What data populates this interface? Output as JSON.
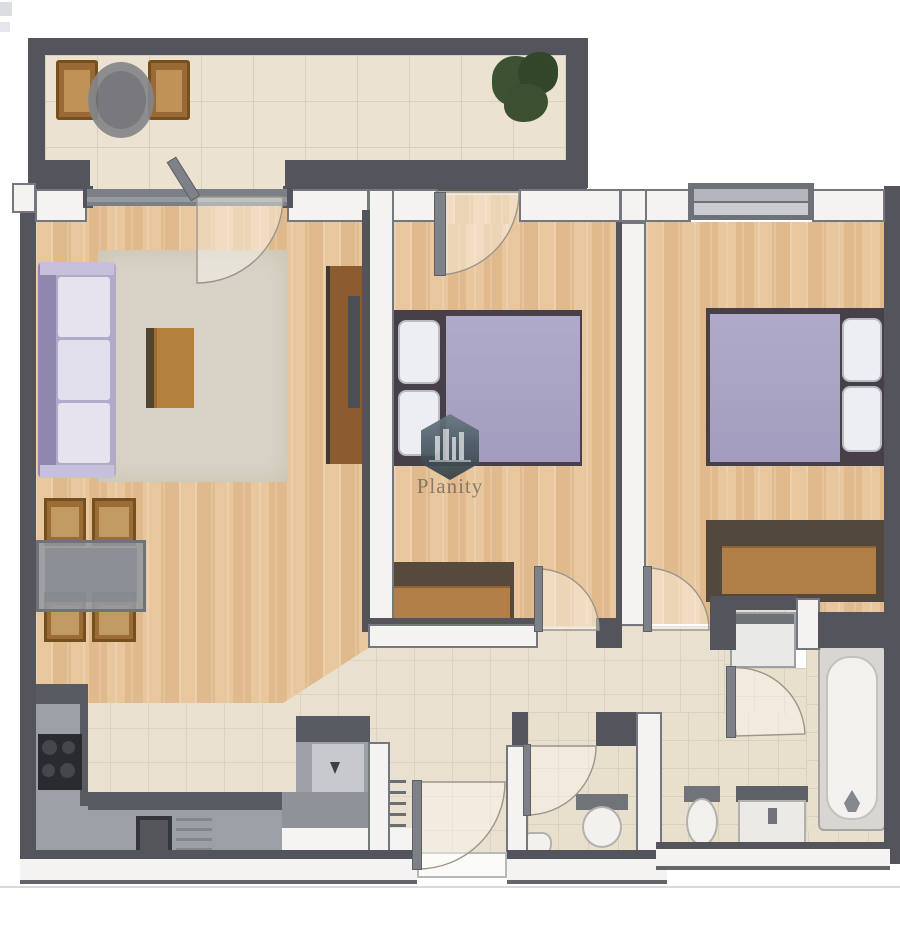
{
  "watermark": {
    "brand": "Planity",
    "logo": "hexagon-with-building-skyline"
  },
  "plan": {
    "type": "apartment-floor-plan-3d-top-view",
    "rooms": [
      {
        "name": "balcony",
        "furniture": [
          "wood-chair",
          "wood-chair",
          "round-table",
          "potted-plant"
        ]
      },
      {
        "name": "living-room",
        "furniture": [
          "lavender-sofa",
          "area-rug",
          "coffee-table",
          "tv-cabinet",
          "dining-table",
          "dining-chair-x4"
        ]
      },
      {
        "name": "kitchen",
        "furniture": [
          "cooktop",
          "sink-with-drainboard",
          "counter-left",
          "counter-bottom",
          "counter-peninsula"
        ]
      },
      {
        "name": "bedroom-1",
        "furniture": [
          "double-bed-lavender",
          "pillow-x2",
          "dresser"
        ]
      },
      {
        "name": "bedroom-2",
        "furniture": [
          "double-bed-lavender",
          "pillow-x2",
          "dresser",
          "window"
        ]
      },
      {
        "name": "entry-hall",
        "furniture": [
          "radiator",
          "entry-door"
        ]
      },
      {
        "name": "wc",
        "furniture": [
          "toilet",
          "corner-sink"
        ]
      },
      {
        "name": "bathroom",
        "furniture": [
          "bathtub",
          "toilet",
          "vanity-sink",
          "washing-machine"
        ]
      }
    ],
    "doors": [
      "living-balcony-door",
      "bedroom1-balcony-door",
      "bedroom1-door",
      "bedroom2-door",
      "wc-door",
      "bathroom-door",
      "entry-door"
    ]
  },
  "colors": {
    "wall_dark": "#53545c",
    "wall_white": "#f4f3f1",
    "wood_floor": "#e5c094",
    "tile_floor": "#eae0cf",
    "duvet_lavender": "#a8a2c2",
    "sofa_lavender": "#b2aacb",
    "counter_gray": "#9aa0a6",
    "fixture_white": "#f2f1ee",
    "plant_green": "#3d5233",
    "watermark_hex": "#4b5b64"
  }
}
